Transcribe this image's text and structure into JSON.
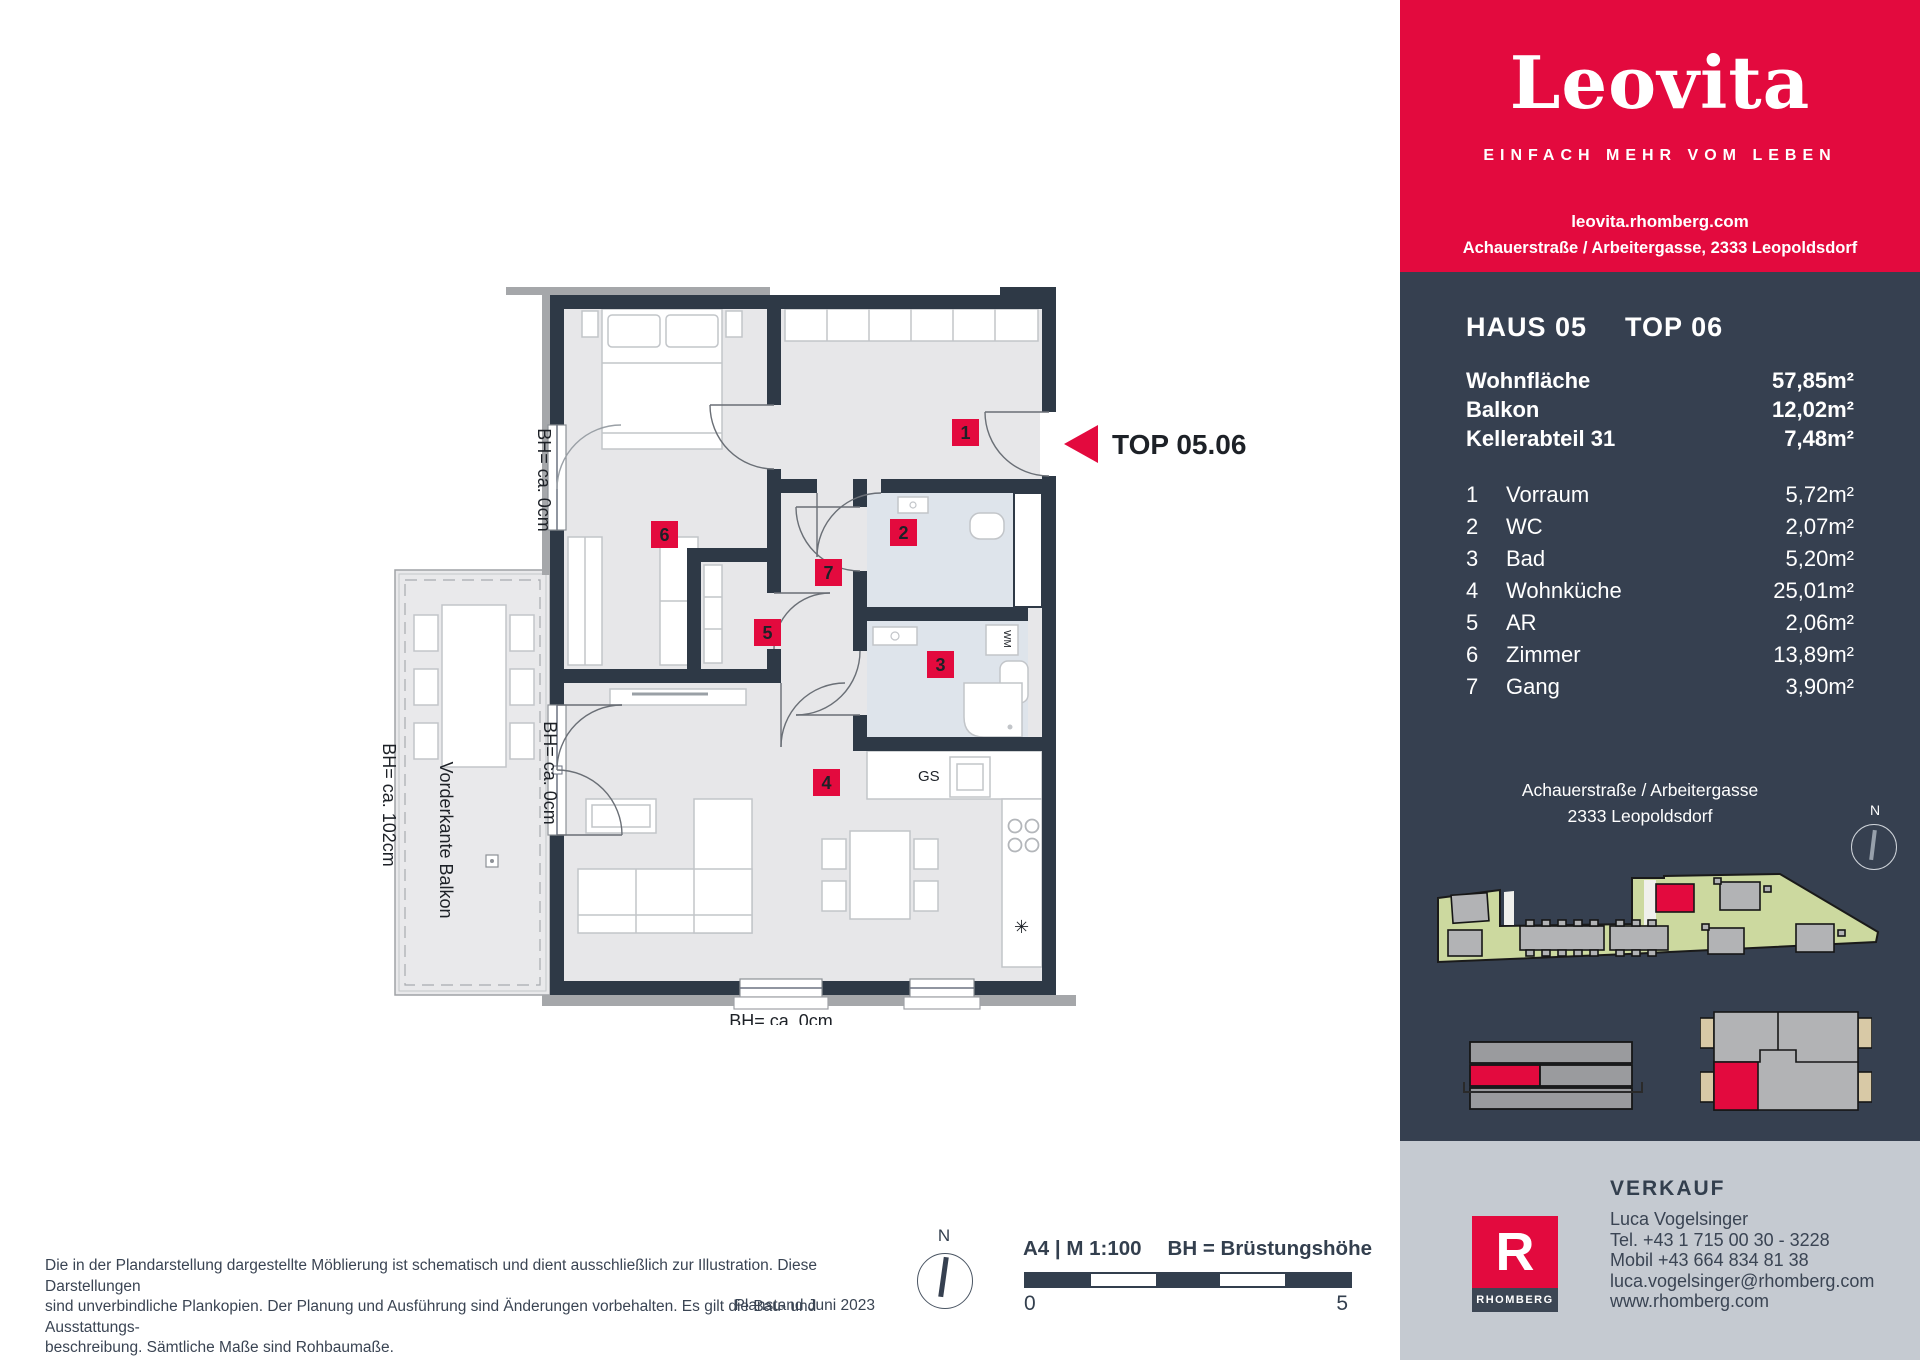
{
  "colors": {
    "accent_red": "#e30a3e",
    "panel_navy": "#364050",
    "wall_navy": "#2e3946",
    "footer_gray": "#c5cad1",
    "site_green": "#ccd99f"
  },
  "header": {
    "logo": "Leovita",
    "tagline": "EINFACH MEHR VOM LEBEN",
    "url": "leovita.rhomberg.com",
    "address": "Achauerstraße / Arbeitergasse, 2333 Leopoldsdorf"
  },
  "unit": {
    "haus": "HAUS 05",
    "top": "TOP 06",
    "areas": [
      {
        "label": "Wohnfläche",
        "value": "57,85m²"
      },
      {
        "label": "Balkon",
        "value": "12,02m²"
      },
      {
        "label": "Kellerabteil 31",
        "value": "7,48m²"
      }
    ],
    "rooms": [
      {
        "nr": "1",
        "name": "Vorraum",
        "area": "5,72m²"
      },
      {
        "nr": "2",
        "name": "WC",
        "area": "2,07m²"
      },
      {
        "nr": "3",
        "name": "Bad",
        "area": "5,20m²"
      },
      {
        "nr": "4",
        "name": "Wohnküche",
        "area": "25,01m²"
      },
      {
        "nr": "5",
        "name": "AR",
        "area": "2,06m²"
      },
      {
        "nr": "6",
        "name": "Zimmer",
        "area": "13,89m²"
      },
      {
        "nr": "7",
        "name": "Gang",
        "area": "3,90m²"
      }
    ]
  },
  "location": {
    "line1": "Achauerstraße / Arbeitergasse",
    "line2": "2333 Leopoldsdorf",
    "compass_n": "N"
  },
  "plan": {
    "top_label": "TOP 05.06",
    "bh0_window": "BH= ca. 0cm",
    "bh0_balcony_door": "BH= ca. 0cm",
    "bh102": "BH= ca. 102cm",
    "vorderkante": "Vorderkante Balkon",
    "bh0_bottom1": "BH= ca. 0cm",
    "bh0_bottom2": "BH= ca. 0cm",
    "kitchen": {
      "gs": "GS",
      "wm": "WM",
      "fridge_symbol": "✳"
    }
  },
  "legend": {
    "compass_n": "N",
    "format": "A4 | M 1:100",
    "bh_note": "BH = Brüstungshöhe",
    "scale_start": "0",
    "scale_end": "5"
  },
  "disclaimer": {
    "line1": "Die in der Plandarstellung dargestellte Möblierung ist schematisch und dient ausschließlich zur Illustration. Diese Darstellungen",
    "line2": "sind unverbindliche Plankopien. Der Planung und Ausführung sind Änderungen vorbehalten. Es gilt die Bau- und Ausstattungs-",
    "line3": "beschreibung. Sämtliche Maße sind Rohbaumaße.",
    "planstand": "Planstand Juni 2023"
  },
  "verkauf": {
    "heading": "VERKAUF",
    "name": "Luca Vogelsinger",
    "tel": "Tel. +43 1 715 00 30 - 3228",
    "mobil": "Mobil +43 664 834 81 38",
    "email": "luca.vogelsinger@rhomberg.com",
    "web": "www.rhomberg.com",
    "logo_letter": "R",
    "logo_text": "RHOMBERG"
  }
}
